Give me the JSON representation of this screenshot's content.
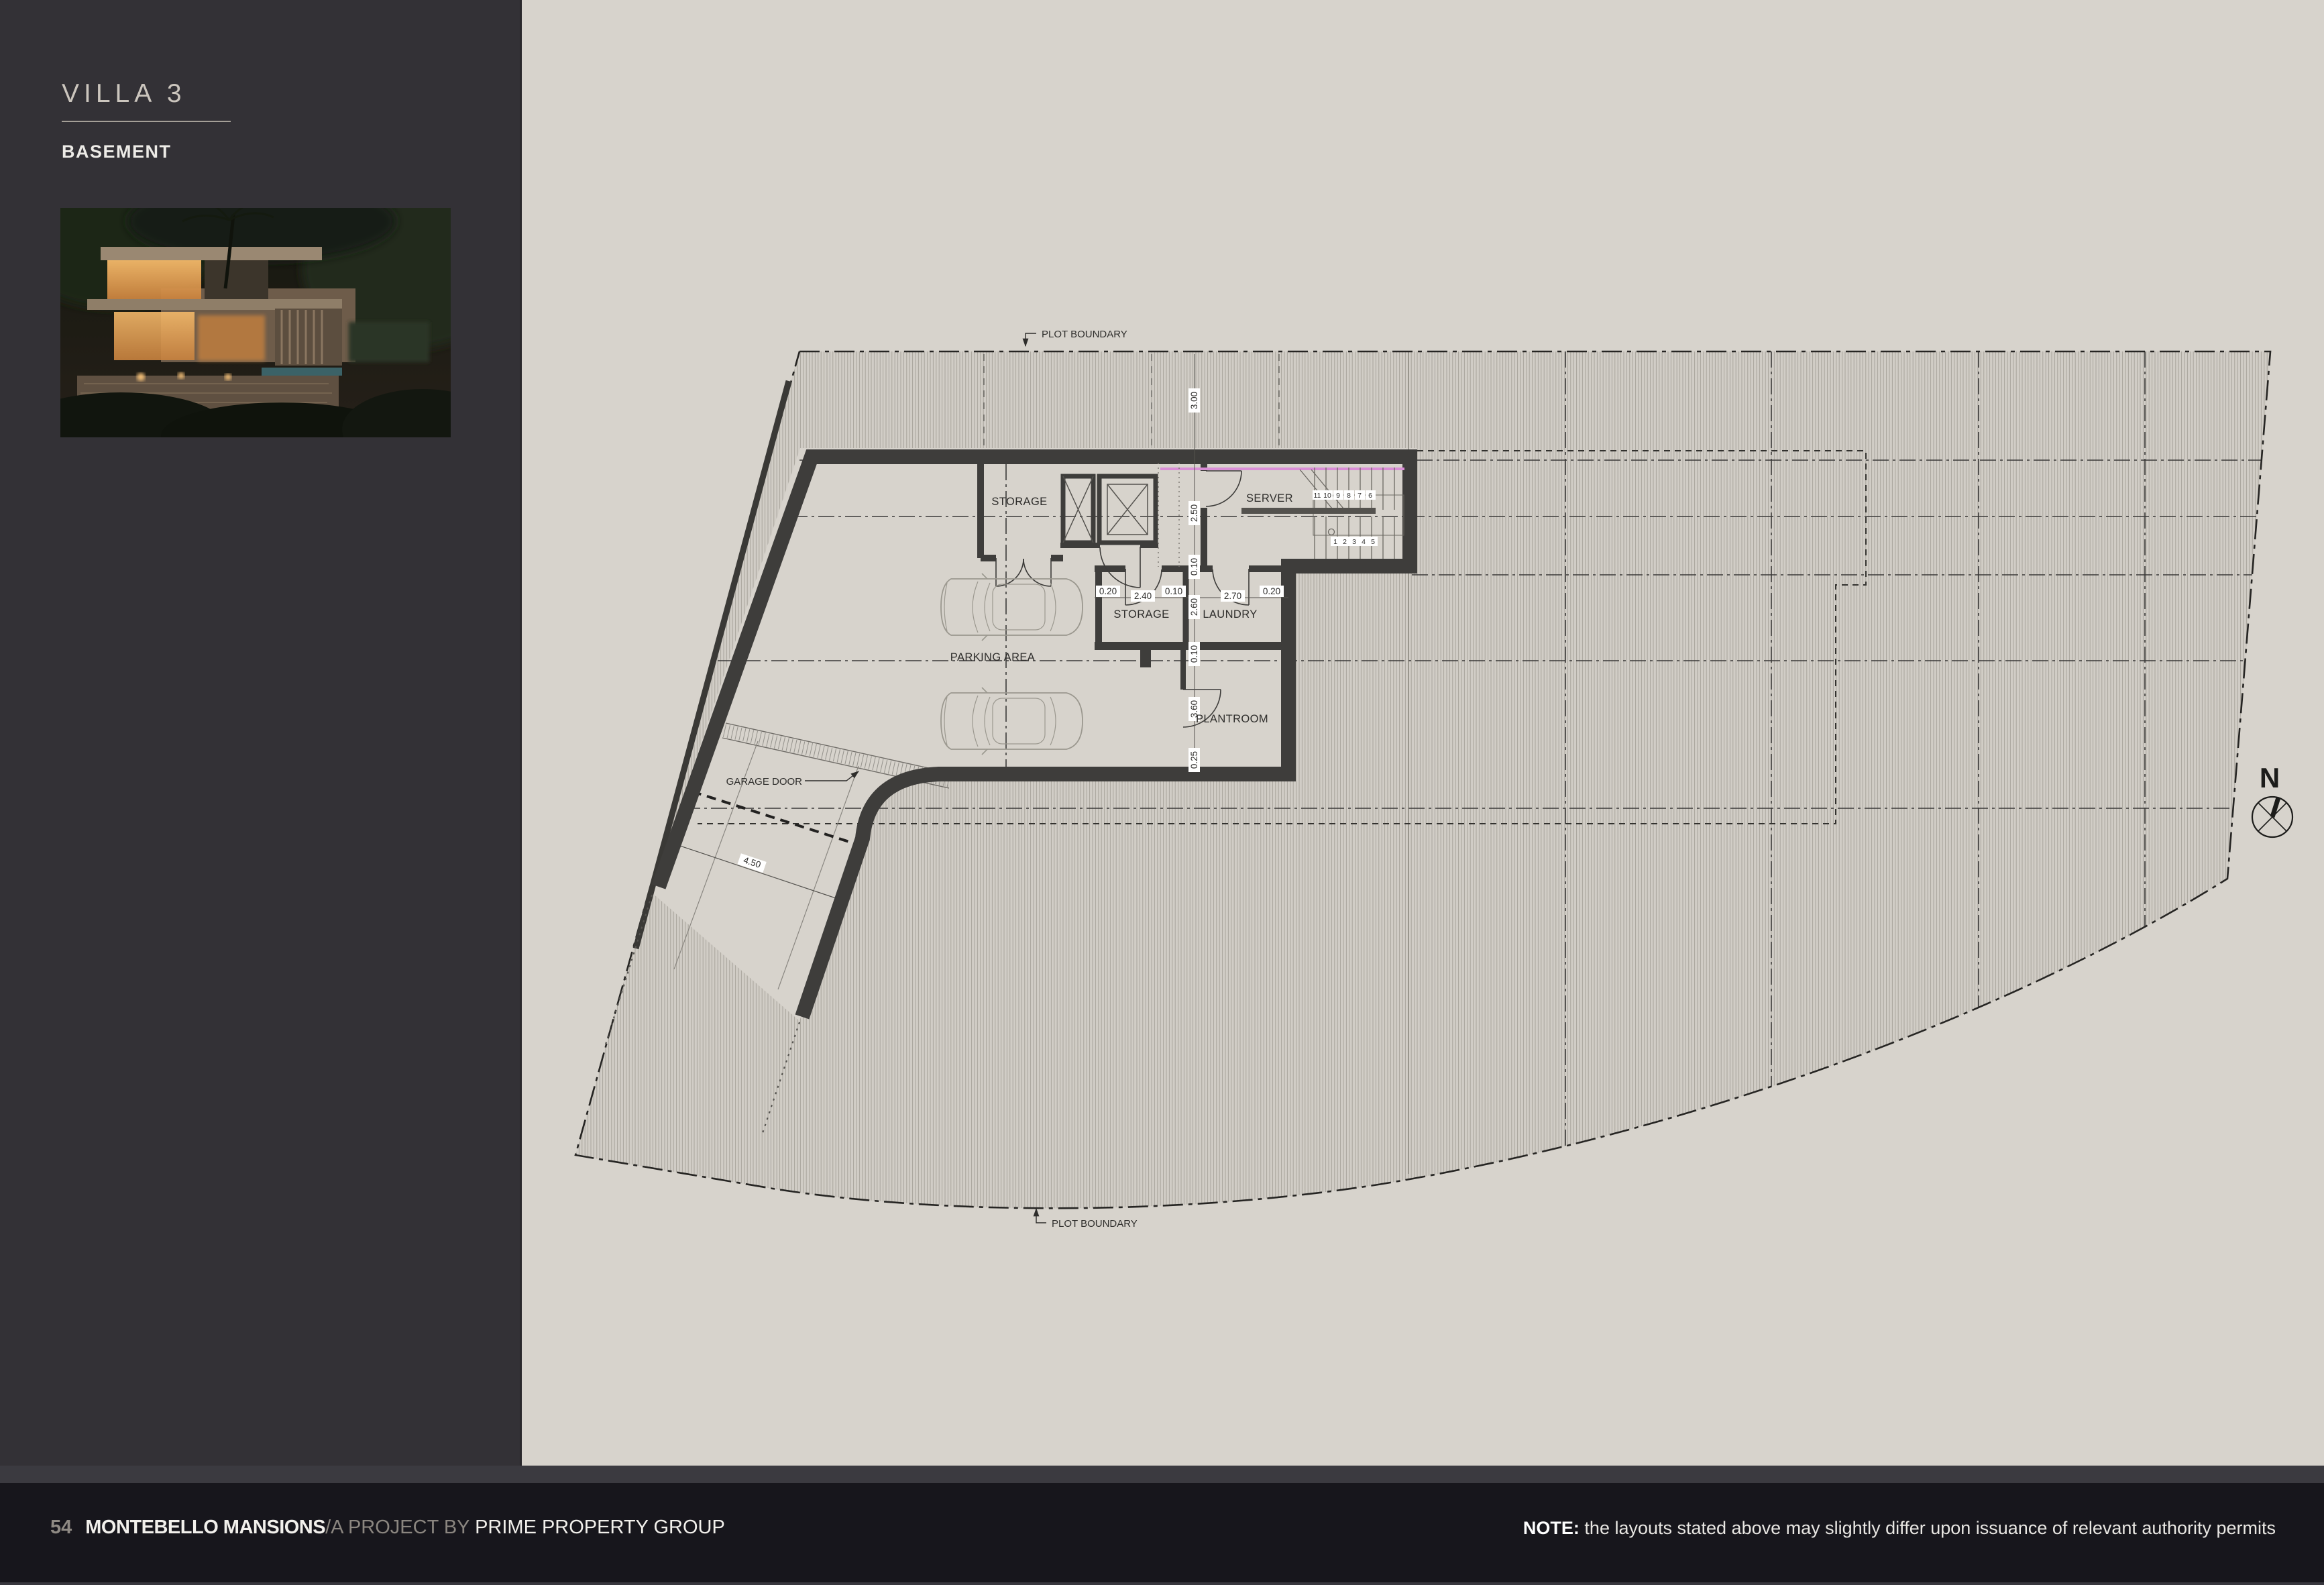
{
  "sidebar": {
    "title": "VILLA 3",
    "subtitle": "BASEMENT"
  },
  "plan": {
    "labels": {
      "plot_boundary_top": "PLOT BOUNDARY",
      "plot_boundary_bottom": "PLOT BOUNDARY",
      "storage_upper": "STORAGE",
      "server": "SERVER",
      "storage_lower": "STORAGE",
      "laundry": "LAUNDRY",
      "parking": "PARKING AREA",
      "plantroom": "PLANTROOM",
      "garage_door": "GARAGE DOOR",
      "north": "N"
    },
    "dims_v": [
      "3.00",
      "2.50",
      "0.10",
      "2.60",
      "0.10",
      "3.60",
      "0.25"
    ],
    "dims_h": [
      "0.20",
      "2.40",
      "0.10",
      "2.70",
      "0.20"
    ],
    "dim_ramp": "4.50",
    "stair_numbers": [
      "11",
      "10",
      "9",
      "8",
      "7",
      "6",
      "1",
      "2",
      "3",
      "4",
      "5"
    ],
    "colors": {
      "insulation_accent": "#da8ed6",
      "wall": "#3e3d3b",
      "paper": "#d7d3cc",
      "sidebar_bg": "#333136",
      "footer_bg": "#17161c"
    }
  },
  "footer": {
    "page_number": "54",
    "brand": "MONTEBELLO MANSIONS",
    "project_by": "/A PROJECT BY ",
    "company": "PRIME PROPERTY GROUP",
    "note_label": "NOTE:",
    "note_text": " the layouts stated above may slightly differ upon issuance of relevant authority permits"
  }
}
